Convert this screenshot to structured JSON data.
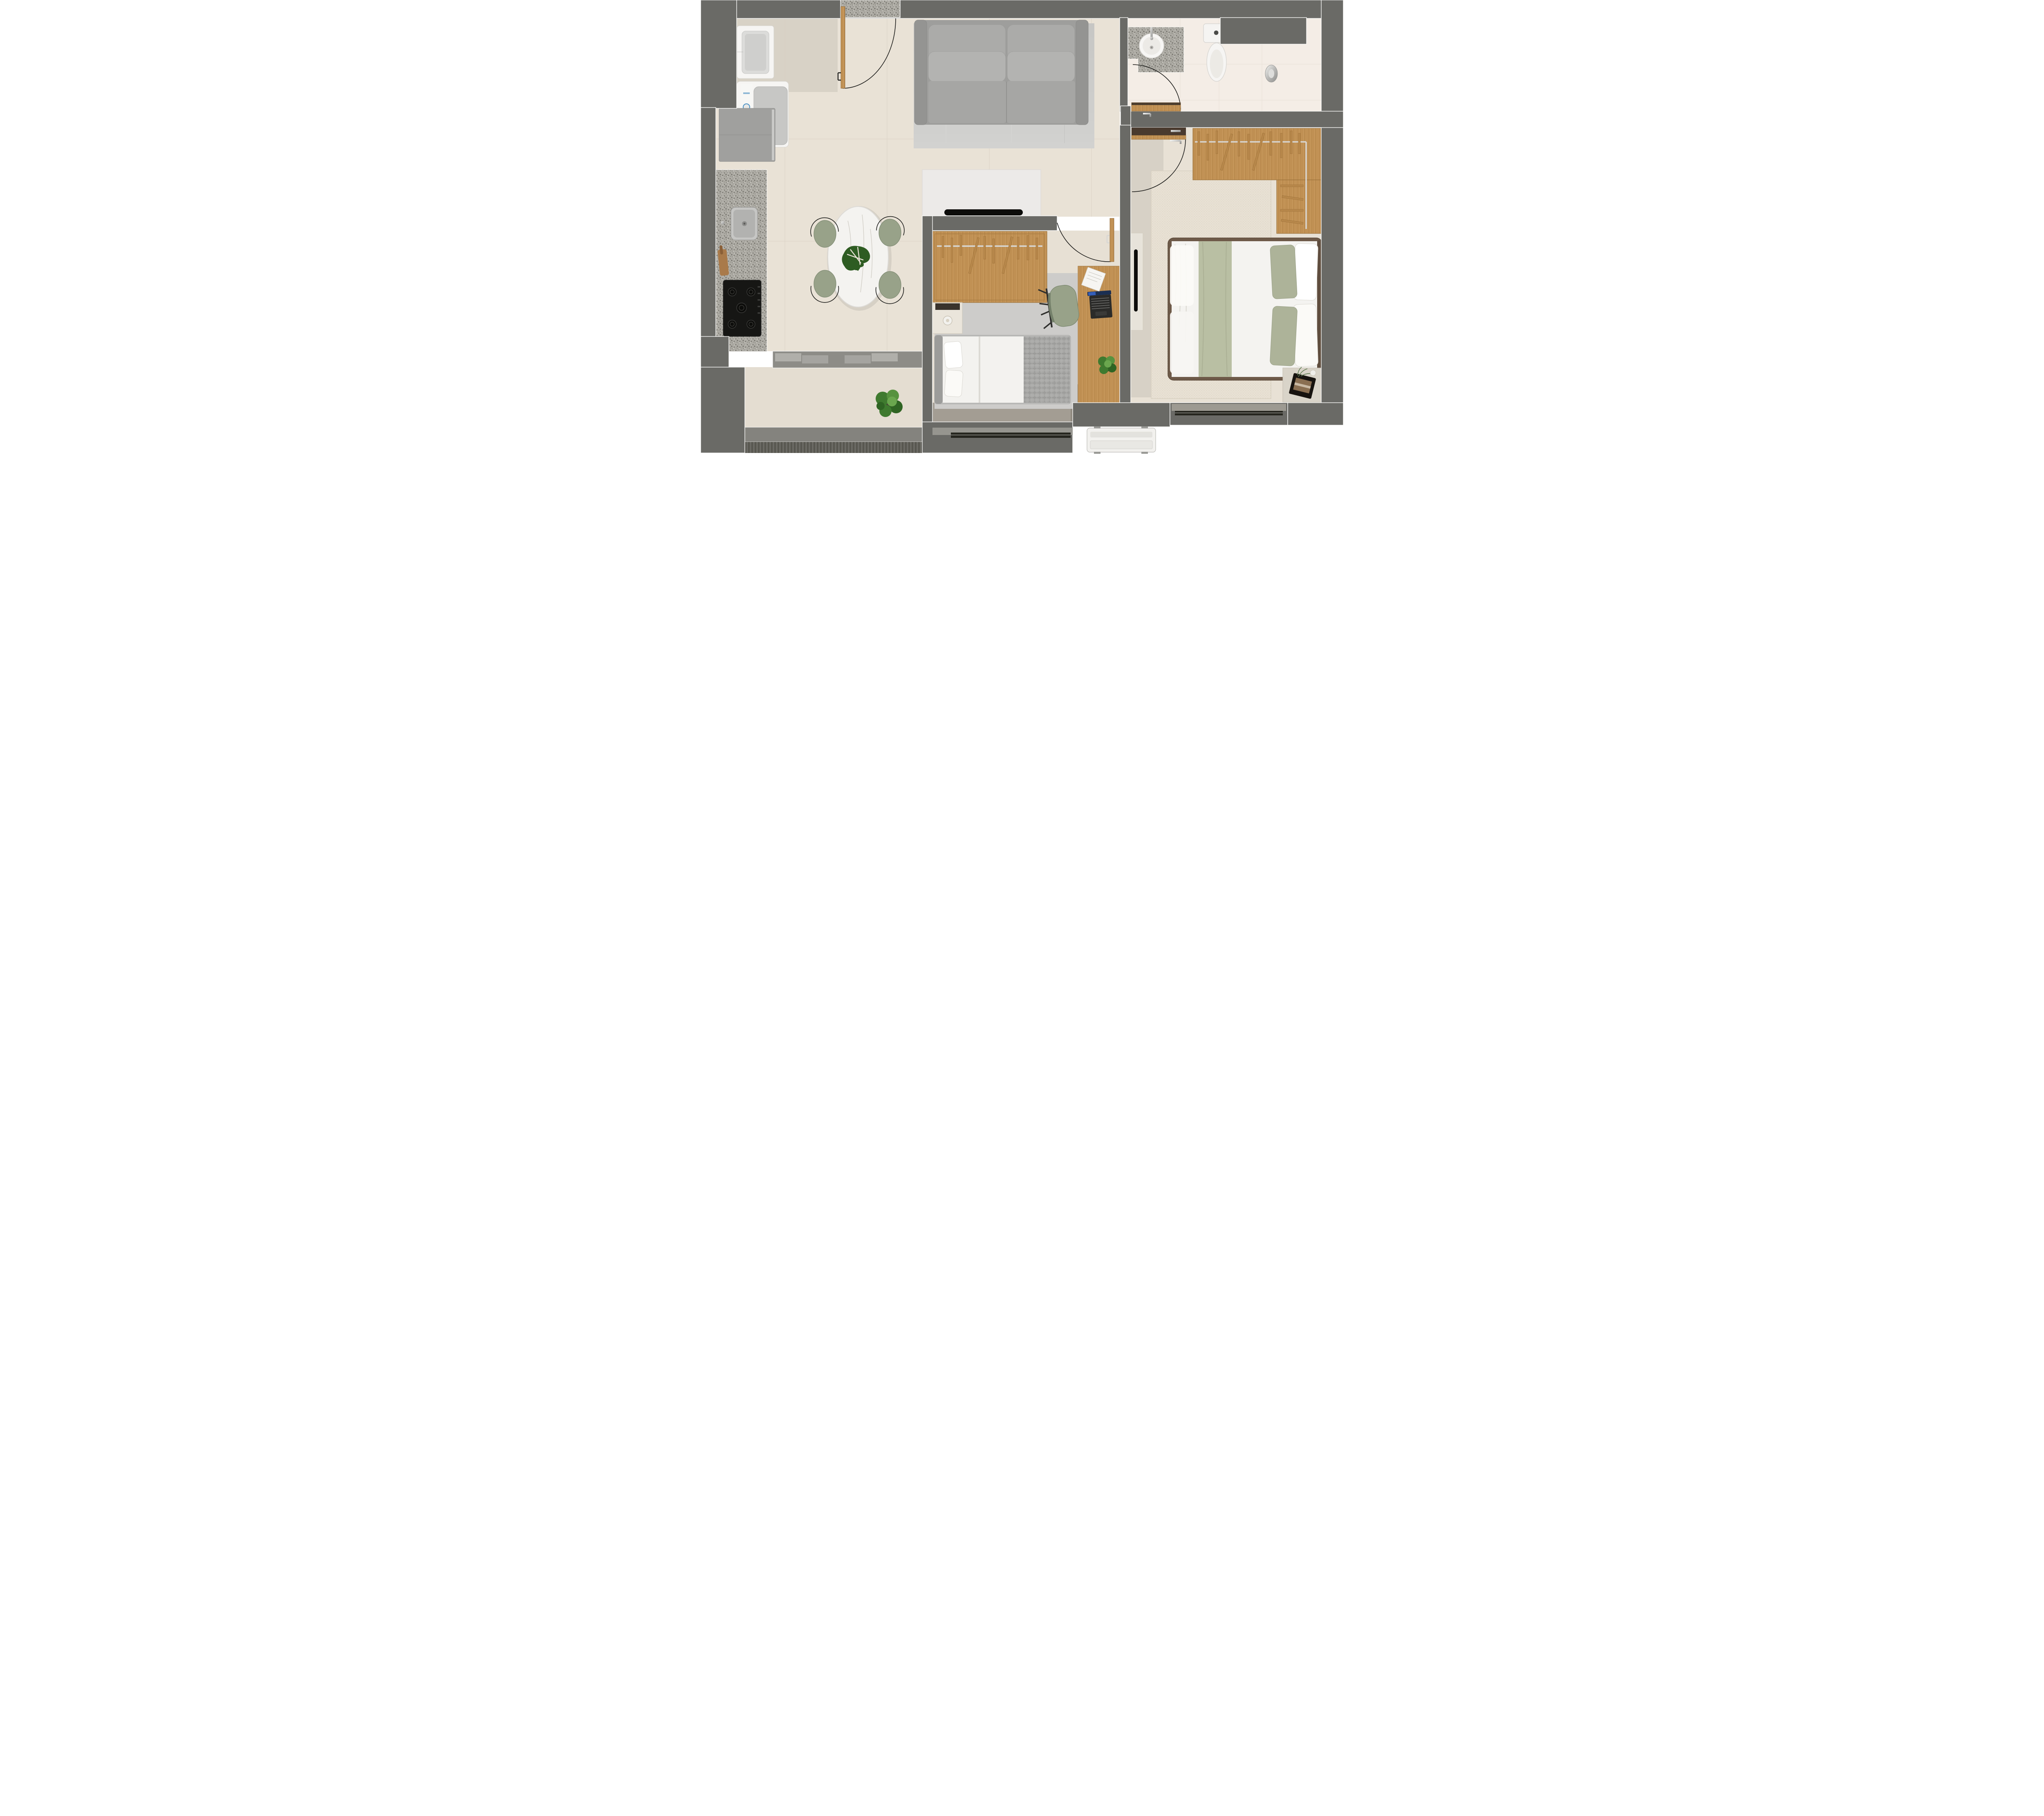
{
  "title": "apartment-floor-plan",
  "palette": {
    "wall": "#6a6a66",
    "wall_outline": "#fafaf8",
    "outer_dark": "#5f5e5a",
    "floor_living": "#e9e2d6",
    "floor_service": "#e4ddd1",
    "floor_bath": "#f4ede6",
    "floor_master": "#e8e1d5",
    "floor_bed2": "#e7e0d4",
    "floor_shadow": "#a39d93",
    "granite": "#aeaca5",
    "wood": "#c29255",
    "wood_dark": "#4a3a2e",
    "sofa": "#9e9e9c",
    "sofa_cushion": "#ababa9",
    "rug_living": "#cbcbc9",
    "rug_bed2": "#cdccca",
    "rug_master": "#e8e1d4",
    "chair_sage": "#98a289",
    "marble": "#f4f3f0",
    "blanket_gray": "#a9a9a7",
    "duvet_white": "#f4f3f0",
    "runner_sage": "#b9bfa3",
    "pillow_sage": "#adb399",
    "bed_frame_brown": "#6e5a49",
    "headboard_brown": "#5f4d3e",
    "appliance_white": "#f2f1ee",
    "steel": "#c9c9c7",
    "window_glass": "#26261f",
    "sill": "#96958f",
    "plant_green": "#3f7a2f",
    "tv_black": "#0c0c0a"
  },
  "rooms": {
    "kitchen": {
      "name": "kitchen",
      "furniture": [
        "laundry-tank",
        "washing-machine",
        "refrigerator",
        "granite-counter",
        "kitchen-sink",
        "faucet",
        "cooktop-5-burners",
        "utensil-board"
      ]
    },
    "living_dining": {
      "name": "living-dining",
      "furniture": [
        "entry-door",
        "granite-threshold",
        "sofa-2-seat",
        "living-rug",
        "tv-panel",
        "tv",
        "oval-marble-table",
        "monstera-centerpiece",
        "dining-chair-nw",
        "dining-chair-ne",
        "dining-chair-sw",
        "dining-chair-se",
        "window-band",
        "service-plant",
        "balcony-parapet"
      ]
    },
    "bathroom": {
      "name": "bathroom",
      "furniture": [
        "granite-vanity",
        "round-sink",
        "vanity-faucet",
        "toilet",
        "shower-column",
        "wall-niche",
        "bathroom-door"
      ]
    },
    "bedroom2": {
      "name": "single-bedroom",
      "furniture": [
        "open-wardrobe",
        "hanger-rail",
        "single-bed",
        "pillows",
        "plaid-blanket",
        "nightstand",
        "table-lamp",
        "desk",
        "desk-chair",
        "laptop",
        "paper-sheet",
        "desk-plant",
        "bedroom2-door",
        "bedroom2-window"
      ]
    },
    "master_bedroom": {
      "name": "couple-bedroom",
      "furniture": [
        "l-shaped-wardrobe",
        "hanger-rail",
        "double-bed",
        "sage-runner",
        "pillows",
        "master-rug",
        "tv-cabinet",
        "wall-tv",
        "nightstand-tray-plant",
        "master-door",
        "master-window"
      ]
    },
    "exterior": {
      "name": "exterior",
      "furniture": [
        "ac-condenser-unit"
      ]
    }
  },
  "counts": {
    "dining_chairs": 4,
    "cooktop_burners": 5,
    "bed2_pillows": 2,
    "master_pillow_pairs": 2
  }
}
